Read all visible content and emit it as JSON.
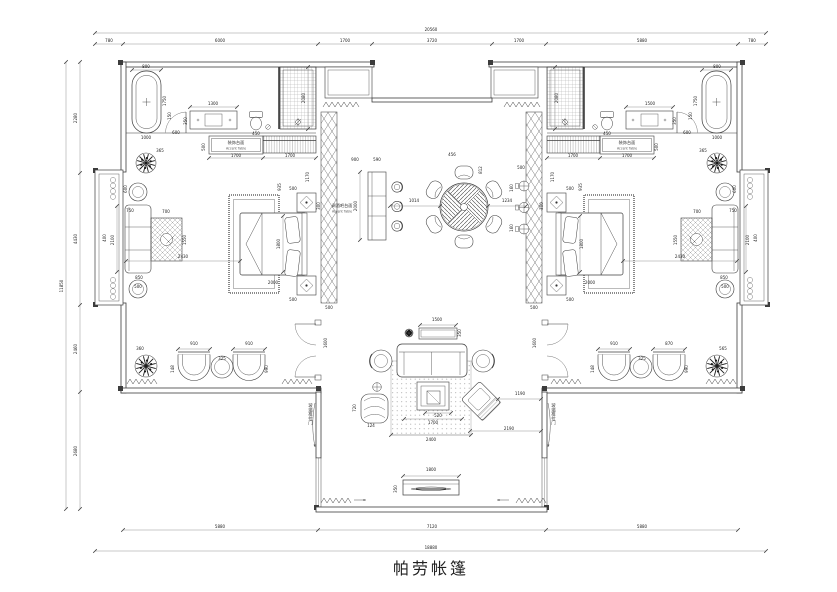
{
  "title": "帕劳帐篷",
  "labels": {
    "counter_cn": "装饰台面",
    "counter_en": "Accent Table",
    "bar_line1": "调酒吧台面",
    "bar_line2": "Accent Table",
    "slide_door": "玻璃推拉门"
  },
  "annotations": [
    [
      "20560",
      431,
      31
    ],
    [
      "780",
      109,
      42
    ],
    [
      "6000",
      220,
      42
    ],
    [
      "1700",
      345,
      42
    ],
    [
      "3720",
      432,
      42
    ],
    [
      "1700",
      519,
      42
    ],
    [
      "5880",
      642,
      42
    ],
    [
      "780",
      752,
      42
    ],
    [
      "11850",
      63,
      286,
      1
    ],
    [
      "2280",
      77,
      118,
      1
    ],
    [
      "4430",
      77,
      239,
      1
    ],
    [
      "2460",
      77,
      349,
      1
    ],
    [
      "2680",
      77,
      451,
      1
    ],
    [
      "5880",
      220,
      528
    ],
    [
      "7120",
      432,
      528
    ],
    [
      "5880",
      642,
      528
    ],
    [
      "18880",
      431,
      549
    ],
    [
      "800",
      146,
      68
    ],
    [
      "1750",
      166,
      101,
      1
    ],
    [
      "1000",
      146,
      139
    ],
    [
      "600",
      176,
      134
    ],
    [
      "1300",
      213,
      105
    ],
    [
      "350",
      187,
      121,
      1
    ],
    [
      "450",
      256,
      135
    ],
    [
      "2080",
      305,
      98,
      1
    ],
    [
      "150",
      171,
      116,
      1
    ],
    [
      "800",
      717,
      68
    ],
    [
      "1750",
      697,
      101,
      1
    ],
    [
      "1000",
      717,
      139
    ],
    [
      "600",
      687,
      134
    ],
    [
      "1500",
      650,
      105
    ],
    [
      "350",
      676,
      121,
      1
    ],
    [
      "450",
      607,
      135
    ],
    [
      "2080",
      558,
      98,
      1
    ],
    [
      "150",
      692,
      116,
      1
    ],
    [
      "500",
      205,
      147,
      1
    ],
    [
      "1700",
      236,
      157
    ],
    [
      "1700",
      290,
      157
    ],
    [
      "1170",
      309,
      177,
      1
    ],
    [
      "935",
      281,
      187,
      1
    ],
    [
      "500",
      658,
      147,
      1
    ],
    [
      "1700",
      573,
      157
    ],
    [
      "1700",
      627,
      157
    ],
    [
      "1170",
      554,
      177,
      1
    ],
    [
      "935",
      582,
      187,
      1
    ],
    [
      "365",
      160,
      152
    ],
    [
      "365",
      703,
      152
    ],
    [
      "360",
      140,
      350
    ],
    [
      "565",
      723,
      350
    ],
    [
      "700",
      166,
      213
    ],
    [
      "1550",
      186,
      240,
      1
    ],
    [
      "2100",
      114,
      240,
      1
    ],
    [
      "400",
      106,
      238,
      1
    ],
    [
      "600",
      127,
      189,
      1
    ],
    [
      "850",
      139,
      279
    ],
    [
      "500",
      138,
      288
    ],
    [
      "750",
      130,
      212
    ],
    [
      "700",
      697,
      213
    ],
    [
      "1550",
      677,
      240,
      1
    ],
    [
      "2100",
      749,
      240,
      1
    ],
    [
      "400",
      757,
      238,
      1
    ],
    [
      "600",
      736,
      189,
      1
    ],
    [
      "850",
      724,
      279
    ],
    [
      "500",
      725,
      288
    ],
    [
      "750",
      733,
      212
    ],
    [
      "500",
      293,
      190
    ],
    [
      "500",
      293,
      301
    ],
    [
      "300",
      320,
      206,
      1
    ],
    [
      "1800",
      280,
      244,
      1
    ],
    [
      "2000",
      273,
      284
    ],
    [
      "2430",
      183,
      258
    ],
    [
      "500",
      570,
      190
    ],
    [
      "500",
      570,
      301
    ],
    [
      "300",
      543,
      206,
      1
    ],
    [
      "1800",
      583,
      244,
      1
    ],
    [
      "2000",
      590,
      284
    ],
    [
      "2430",
      680,
      258
    ],
    [
      "500",
      329,
      309
    ],
    [
      "500",
      534,
      309
    ],
    [
      "900",
      355,
      161
    ],
    [
      "590",
      377,
      161
    ],
    [
      "2000",
      357,
      206,
      1
    ],
    [
      "456",
      452,
      156
    ],
    [
      "812",
      482,
      170,
      1
    ],
    [
      "1014",
      414,
      202
    ],
    [
      "1234",
      507,
      202
    ],
    [
      "160",
      513,
      188,
      1
    ],
    [
      "160",
      513,
      228,
      1
    ],
    [
      "500",
      521,
      169
    ],
    [
      "910",
      194,
      345
    ],
    [
      "910",
      249,
      345
    ],
    [
      "325",
      222,
      360
    ],
    [
      "148",
      174,
      369,
      1
    ],
    [
      "990",
      268,
      369,
      1
    ],
    [
      "910",
      614,
      345
    ],
    [
      "870",
      669,
      345
    ],
    [
      "325",
      642,
      360
    ],
    [
      "148",
      594,
      369,
      1
    ],
    [
      "990",
      688,
      369,
      1
    ],
    [
      "1600",
      327,
      343,
      1
    ],
    [
      "1600",
      536,
      343,
      1
    ],
    [
      "1500",
      437,
      321
    ],
    [
      "350",
      461,
      333,
      1
    ],
    [
      "2400",
      431,
      441
    ],
    [
      "1700",
      433,
      424
    ],
    [
      "520",
      438,
      417
    ],
    [
      "720",
      356,
      408,
      1
    ],
    [
      "124",
      371,
      427
    ],
    [
      "1190",
      520,
      395
    ],
    [
      "2190",
      509,
      430
    ],
    [
      "1800",
      431,
      471
    ],
    [
      "350",
      397,
      489,
      1
    ]
  ]
}
